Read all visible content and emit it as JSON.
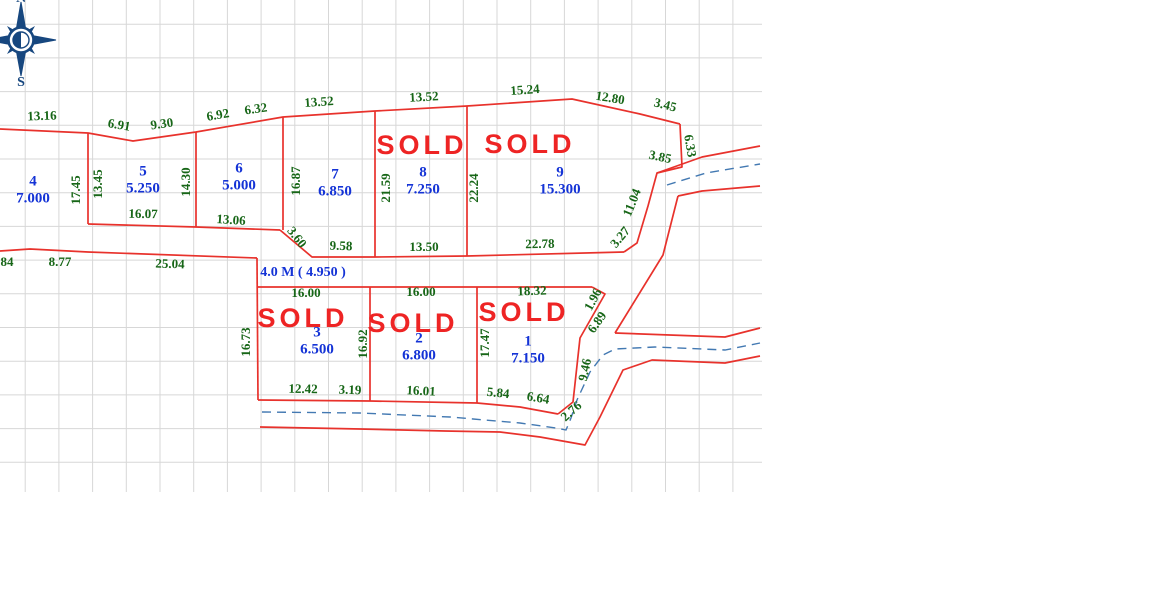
{
  "compass": {
    "north": "N",
    "south": "S"
  },
  "sold_text": "SOLD",
  "road_label": {
    "text": "4.0 M ( 4.950 )",
    "x": 303,
    "y": 271
  },
  "plots": [
    {
      "number": "4",
      "area": "7.000",
      "x": 33,
      "y": 182,
      "sold": false
    },
    {
      "number": "5",
      "area": "5.250",
      "x": 143,
      "y": 172,
      "sold": false
    },
    {
      "number": "6",
      "area": "5.000",
      "x": 239,
      "y": 169,
      "sold": false
    },
    {
      "number": "7",
      "area": "6.850",
      "x": 335,
      "y": 175,
      "sold": false
    },
    {
      "number": "8",
      "area": "7.250",
      "x": 423,
      "y": 173,
      "sold": true
    },
    {
      "number": "9",
      "area": "15.300",
      "x": 560,
      "y": 173,
      "sold": true
    },
    {
      "number": "3",
      "area": "6.500",
      "x": 317,
      "y": 333,
      "sold": true
    },
    {
      "number": "2",
      "area": "6.800",
      "x": 419,
      "y": 339,
      "sold": true
    },
    {
      "number": "1",
      "area": "7.150",
      "x": 528,
      "y": 342,
      "sold": true
    }
  ],
  "sold_marks": [
    {
      "x": 422,
      "y": 147
    },
    {
      "x": 530,
      "y": 146
    },
    {
      "x": 303,
      "y": 320
    },
    {
      "x": 413,
      "y": 325
    },
    {
      "x": 524,
      "y": 314
    }
  ],
  "dimensions": [
    {
      "text": "0",
      "x": -5,
      "y": 117,
      "rot": 0
    },
    {
      "text": "13.16",
      "x": 42,
      "y": 117,
      "rot": -2
    },
    {
      "text": "6.91",
      "x": 119,
      "y": 126,
      "rot": 10
    },
    {
      "text": "9.30",
      "x": 162,
      "y": 125,
      "rot": -8
    },
    {
      "text": "6.92",
      "x": 218,
      "y": 116,
      "rot": -10
    },
    {
      "text": "6.32",
      "x": 256,
      "y": 110,
      "rot": -8
    },
    {
      "text": "13.52",
      "x": 319,
      "y": 103,
      "rot": -4
    },
    {
      "text": "13.52",
      "x": 424,
      "y": 98,
      "rot": -3
    },
    {
      "text": "15.24",
      "x": 525,
      "y": 91,
      "rot": -4
    },
    {
      "text": "12.80",
      "x": 610,
      "y": 99,
      "rot": 9
    },
    {
      "text": "3.45",
      "x": 665,
      "y": 106,
      "rot": 14
    },
    {
      "text": "6.33",
      "x": 689,
      "y": 146,
      "rot": 80
    },
    {
      "text": "3.85",
      "x": 660,
      "y": 158,
      "rot": 12
    },
    {
      "text": "11.04",
      "x": 633,
      "y": 203,
      "rot": -68
    },
    {
      "text": "3.27",
      "x": 621,
      "y": 238,
      "rot": -50
    },
    {
      "text": "17.45",
      "x": 77,
      "y": 190,
      "rot": -90
    },
    {
      "text": "13.45",
      "x": 99,
      "y": 184,
      "rot": -90
    },
    {
      "text": "14.30",
      "x": 187,
      "y": 182,
      "rot": -90
    },
    {
      "text": "16.87",
      "x": 297,
      "y": 181,
      "rot": -90
    },
    {
      "text": "21.59",
      "x": 387,
      "y": 188,
      "rot": -90
    },
    {
      "text": "22.24",
      "x": 475,
      "y": 188,
      "rot": -90
    },
    {
      "text": "16.07",
      "x": 143,
      "y": 215,
      "rot": 1
    },
    {
      "text": "13.06",
      "x": 231,
      "y": 221,
      "rot": 4
    },
    {
      "text": "3.60",
      "x": 296,
      "y": 238,
      "rot": 52
    },
    {
      "text": "9.58",
      "x": 341,
      "y": 247,
      "rot": 2
    },
    {
      "text": "13.50",
      "x": 424,
      "y": 248,
      "rot": 0
    },
    {
      "text": "22.78",
      "x": 540,
      "y": 245,
      "rot": -1
    },
    {
      "text": "84",
      "x": 7,
      "y": 263,
      "rot": 0
    },
    {
      "text": "8.77",
      "x": 60,
      "y": 263,
      "rot": 0
    },
    {
      "text": "25.04",
      "x": 170,
      "y": 265,
      "rot": 2
    },
    {
      "text": "16.00",
      "x": 306,
      "y": 294,
      "rot": 0
    },
    {
      "text": "16.00",
      "x": 421,
      "y": 293,
      "rot": 0
    },
    {
      "text": "18.32",
      "x": 532,
      "y": 292,
      "rot": -2
    },
    {
      "text": "1.96",
      "x": 594,
      "y": 300,
      "rot": -62
    },
    {
      "text": "6.89",
      "x": 598,
      "y": 323,
      "rot": -55
    },
    {
      "text": "9.46",
      "x": 586,
      "y": 370,
      "rot": -78
    },
    {
      "text": "2.76",
      "x": 572,
      "y": 412,
      "rot": -42
    },
    {
      "text": "16.73",
      "x": 247,
      "y": 342,
      "rot": -90
    },
    {
      "text": "16.92",
      "x": 364,
      "y": 344,
      "rot": -90
    },
    {
      "text": "17.47",
      "x": 486,
      "y": 343,
      "rot": -90
    },
    {
      "text": "12.42",
      "x": 303,
      "y": 390,
      "rot": 1
    },
    {
      "text": "3.19",
      "x": 350,
      "y": 391,
      "rot": 2
    },
    {
      "text": "16.01",
      "x": 421,
      "y": 392,
      "rot": 3
    },
    {
      "text": "5.84",
      "x": 498,
      "y": 394,
      "rot": 6
    },
    {
      "text": "6.64",
      "x": 538,
      "y": 399,
      "rot": 10
    }
  ],
  "geometry": {
    "boundaries": [
      [
        [
          0,
          129
        ],
        [
          88,
          133
        ],
        [
          133,
          141
        ],
        [
          196,
          132
        ],
        [
          283,
          117
        ],
        [
          375,
          111
        ],
        [
          467,
          106
        ],
        [
          572,
          99
        ],
        [
          640,
          114
        ],
        [
          680,
          124
        ]
      ],
      [
        [
          680,
          124
        ],
        [
          682,
          167
        ],
        [
          657,
          173
        ],
        [
          648,
          206
        ],
        [
          637,
          243
        ],
        [
          624,
          252
        ]
      ],
      [
        [
          624,
          252
        ],
        [
          467,
          256
        ],
        [
          375,
          257
        ],
        [
          312,
          257
        ],
        [
          280,
          230
        ]
      ],
      [
        [
          280,
          230
        ],
        [
          196,
          227
        ],
        [
          88,
          224
        ]
      ],
      [
        [
          88,
          133
        ],
        [
          88,
          224
        ]
      ],
      [
        [
          196,
          132
        ],
        [
          196,
          227
        ]
      ],
      [
        [
          283,
          117
        ],
        [
          283,
          230
        ]
      ],
      [
        [
          375,
          111
        ],
        [
          375,
          257
        ]
      ],
      [
        [
          467,
          106
        ],
        [
          467,
          256
        ]
      ],
      [
        [
          0,
          251
        ],
        [
          30,
          249
        ],
        [
          88,
          252
        ],
        [
          257,
          258
        ]
      ],
      [
        [
          257,
          258
        ],
        [
          258,
          400
        ]
      ],
      [
        [
          258,
          287
        ],
        [
          592,
          287
        ]
      ],
      [
        [
          592,
          287
        ],
        [
          605,
          294
        ],
        [
          580,
          338
        ],
        [
          573,
          402
        ],
        [
          558,
          414
        ]
      ],
      [
        [
          370,
          287
        ],
        [
          370,
          401
        ]
      ],
      [
        [
          477,
          287
        ],
        [
          477,
          403
        ]
      ],
      [
        [
          258,
          400
        ],
        [
          370,
          401
        ],
        [
          477,
          403
        ],
        [
          520,
          407
        ],
        [
          558,
          414
        ]
      ],
      [
        [
          260,
          427
        ],
        [
          360,
          429
        ],
        [
          445,
          431
        ],
        [
          500,
          432
        ],
        [
          540,
          437
        ],
        [
          585,
          445
        ],
        [
          600,
          417
        ],
        [
          623,
          370
        ],
        [
          652,
          360
        ],
        [
          725,
          363
        ],
        [
          760,
          356
        ]
      ],
      [
        [
          615,
          333
        ],
        [
          725,
          337
        ],
        [
          760,
          328
        ]
      ],
      [
        [
          678,
          196
        ],
        [
          663,
          255
        ],
        [
          615,
          333
        ]
      ],
      [
        [
          657,
          173
        ],
        [
          702,
          157
        ],
        [
          760,
          146
        ]
      ],
      [
        [
          678,
          196
        ],
        [
          702,
          191
        ],
        [
          760,
          186
        ]
      ]
    ],
    "waterlines": [
      [
        [
          262,
          412
        ],
        [
          360,
          413
        ],
        [
          450,
          417
        ],
        [
          520,
          423
        ],
        [
          556,
          428
        ],
        [
          566,
          430
        ],
        [
          571,
          418
        ],
        [
          577,
          400
        ],
        [
          590,
          372
        ],
        [
          603,
          355
        ],
        [
          615,
          349
        ],
        [
          655,
          347
        ],
        [
          725,
          350
        ],
        [
          760,
          343
        ]
      ],
      [
        [
          667,
          185
        ],
        [
          706,
          173
        ],
        [
          760,
          164
        ]
      ]
    ],
    "grid": {
      "x0": 0,
      "y0": 0,
      "x1": 762,
      "y1": 492,
      "startx": 25.2,
      "starty": 24.2,
      "step": 33.7
    }
  },
  "colors": {
    "boundary": "#e8322c",
    "dimension": "#176617",
    "plot_label": "#1433d6",
    "sold": "#ee2424",
    "water": "#4379b2",
    "grid": "#d7d7d7",
    "compass": "#17477f"
  }
}
